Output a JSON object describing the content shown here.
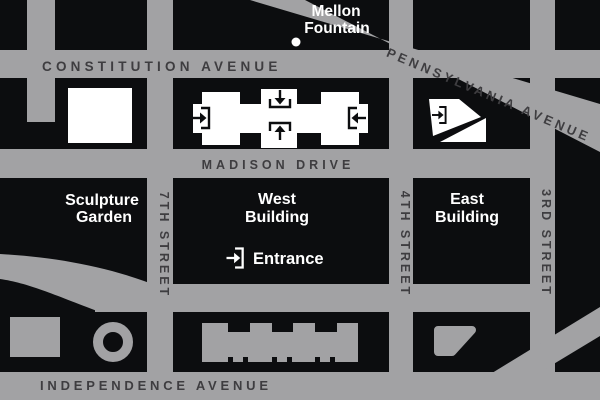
{
  "map": {
    "streets": {
      "constitution_avenue": "CONSTITUTION AVENUE",
      "pennsylvania_avenue": "PENNSYLVANIA AVENUE",
      "madison_drive": "MADISON DRIVE",
      "independence_avenue": "INDEPENDENCE AVENUE",
      "seventh_street": "7TH STREET",
      "fourth_street": "4TH STREET",
      "third_street": "3RD STREET"
    },
    "landmarks": {
      "mellon_fountain": {
        "line1": "Mellon",
        "line2": "Fountain"
      },
      "sculpture_garden": {
        "line1": "Sculpture",
        "line2": "Garden"
      },
      "west_building": {
        "line1": "West",
        "line2": "Building"
      },
      "east_building": {
        "line1": "East",
        "line2": "Building"
      },
      "entrance": "Entrance"
    },
    "colors": {
      "street_gray": "#a2a2a4",
      "block_black": "#0c0d0f",
      "building_white": "#ffffff",
      "street_label_dark": "#3e3d40"
    }
  }
}
